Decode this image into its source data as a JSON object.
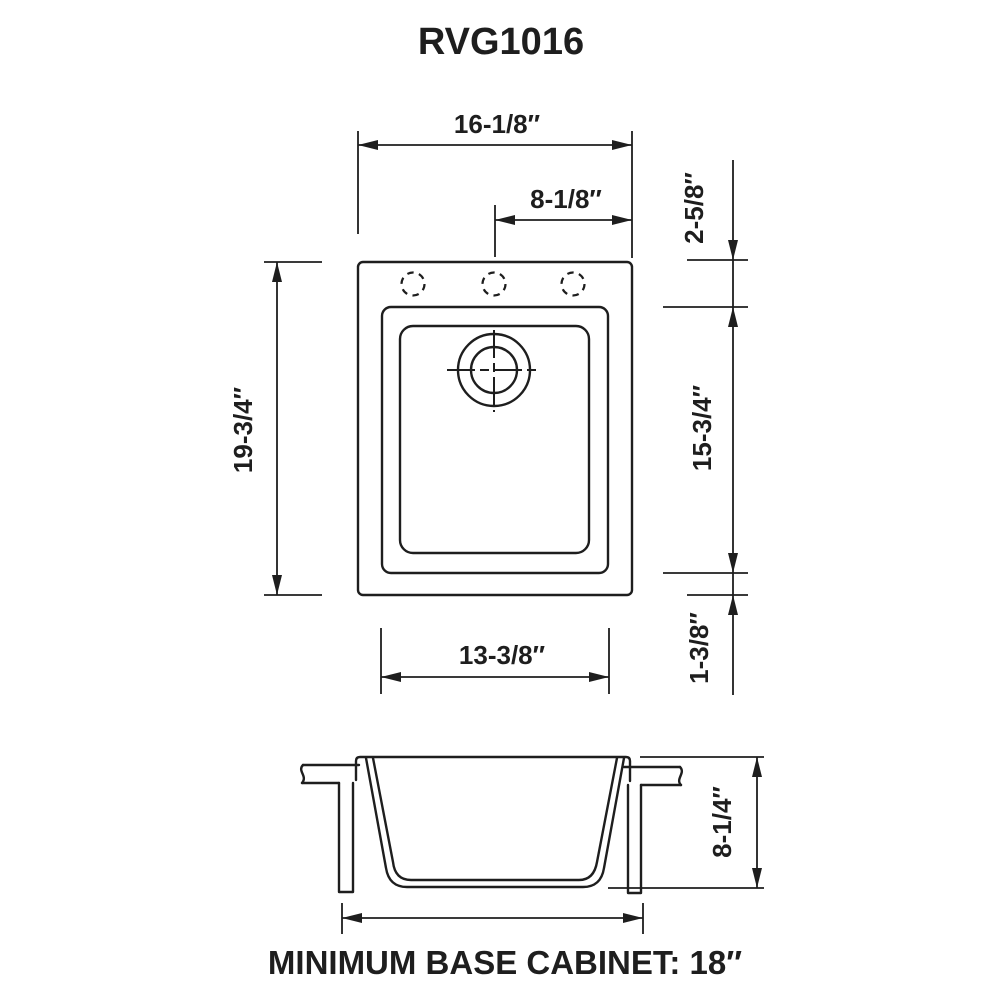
{
  "title": "RVG1016",
  "top_view": {
    "overall_width": "16-1/8″",
    "center_to_edge": "8-1/8″",
    "overall_depth": "19-3/4″",
    "rim_to_bowl_top": "2-5/8″",
    "bowl_length": "15-3/4″",
    "bowl_to_rim_bottom": "1-3/8″",
    "bowl_width": "13-3/8″"
  },
  "side_view": {
    "sink_depth": "8-1/4″"
  },
  "footer": {
    "note": "MINIMUM BASE CABINET: 18″"
  },
  "colors": {
    "line": "#1e1e1e",
    "background": "#ffffff"
  }
}
